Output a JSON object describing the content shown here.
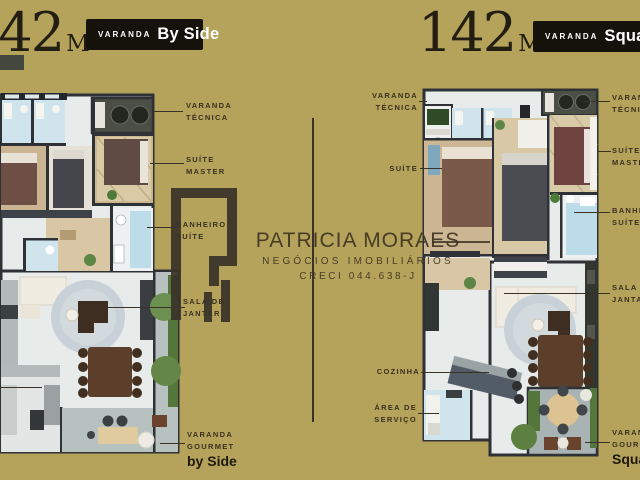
{
  "left_plan": {
    "area_value": "142",
    "area_unit": "M",
    "area_exponent": "2",
    "badge": {
      "prefix": "VARANDA",
      "name": "By Side"
    },
    "labels": [
      {
        "line1": "VARANDA",
        "line2": "TÉCNICA"
      },
      {
        "line1": "SUÍTE",
        "line2": "MASTER"
      },
      {
        "line1": "BANHEIRO",
        "line2": "SUÍTE"
      },
      {
        "line1": "SALA DE",
        "line2": "JANTAR"
      },
      {
        "line1": "VARANDA",
        "line2": "GOURMET",
        "emphasis": "by Side"
      }
    ]
  },
  "right_plan": {
    "area_value": "142",
    "area_unit": "M",
    "area_exponent": "2",
    "badge": {
      "prefix": "VARANDA",
      "name": "Square"
    },
    "left_labels": [
      {
        "line1": "VARANDA",
        "line2": "TÉCNICA"
      },
      {
        "line1": "SUÍTE"
      },
      {
        "line1": "COZINHA"
      },
      {
        "line1": "ÁREA DE",
        "line2": "SERVIÇO"
      }
    ],
    "right_labels": [
      {
        "line1": "VARANDA",
        "line2": "TÉCNICA"
      },
      {
        "line1": "SUÍTE",
        "line2": "MASTER"
      },
      {
        "line1": "BANHEIRO",
        "line2": "SUÍTE"
      },
      {
        "line1": "SALA DE",
        "line2": "JANTAR"
      },
      {
        "line1": "VARANDA",
        "line2": "GOURMET",
        "emphasis": "Square"
      }
    ]
  },
  "watermark": {
    "name": "PATRICIA MORAES",
    "subtitle": "NEGÓCIOS IMOBILIÁRIOS",
    "license": "CRECI 044.638-J"
  },
  "colors": {
    "background": "#b5a35b",
    "badge_background": "#15120c",
    "badge_text": "#ffffff",
    "label_text": "#3a3020",
    "line": "#3a3226",
    "watermark": "#3e3422"
  }
}
